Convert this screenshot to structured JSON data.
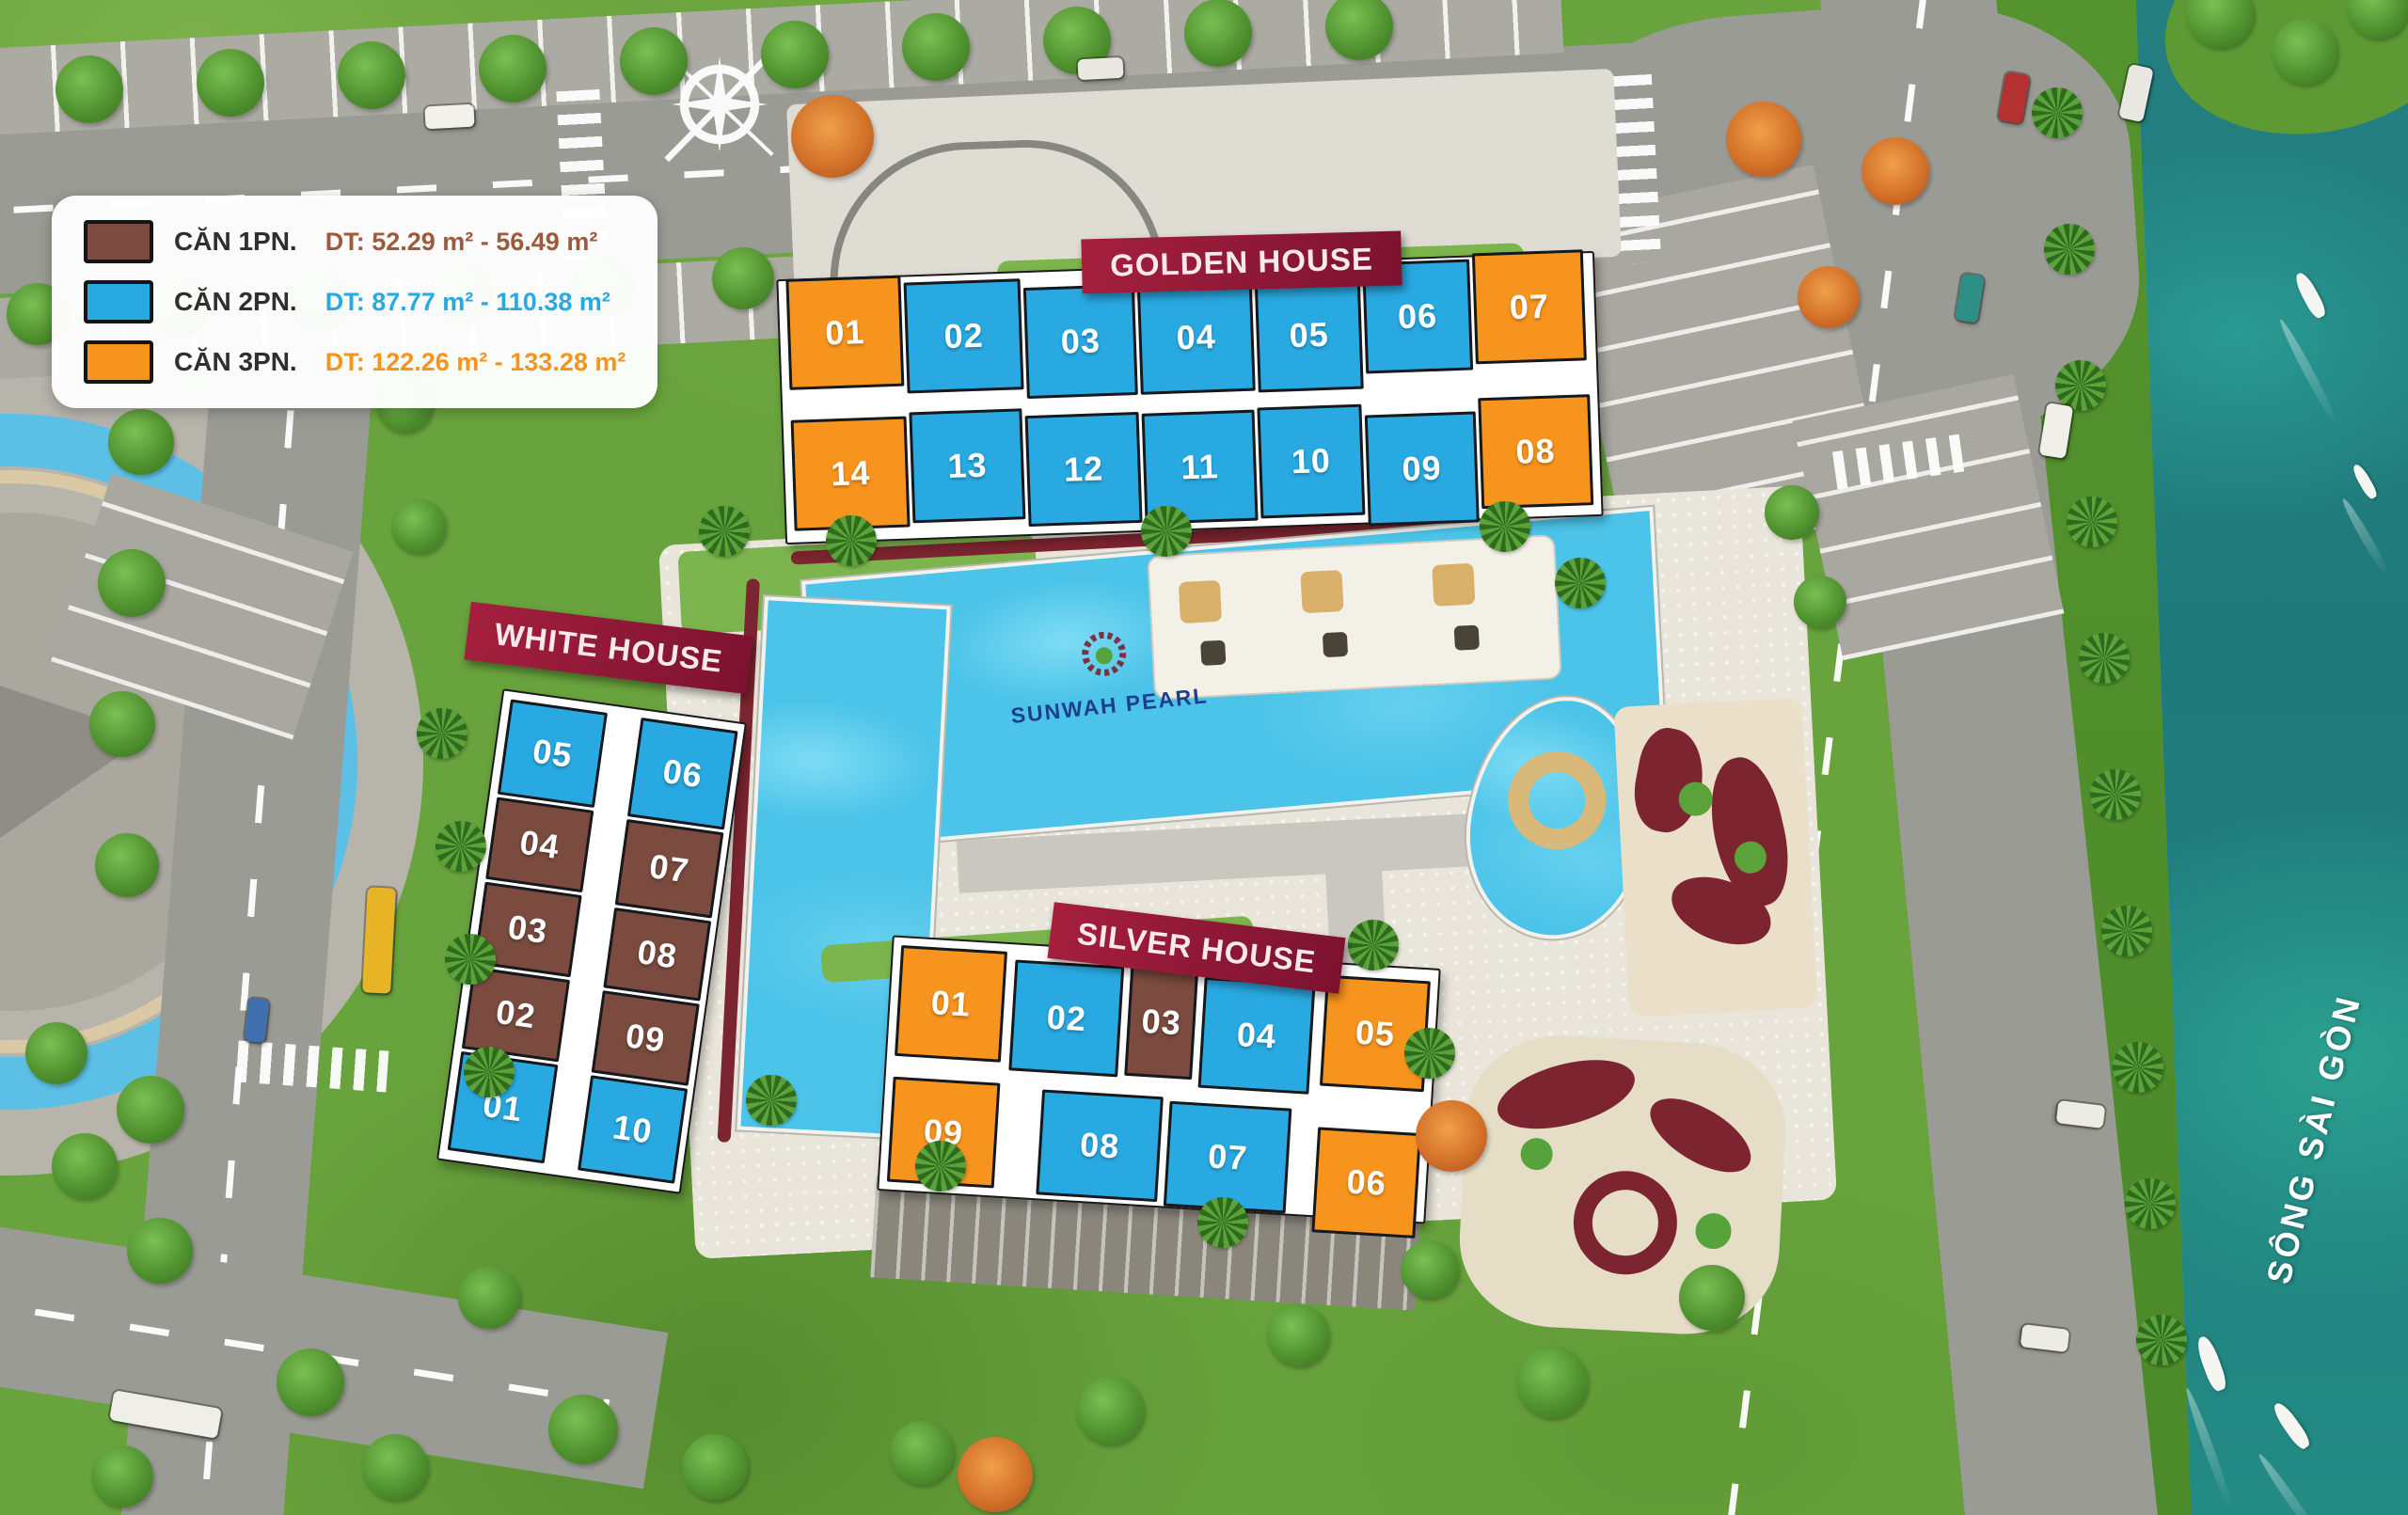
{
  "legend": {
    "items": [
      {
        "label": "CĂN 1PN.",
        "detail": "DT: 52.29 m² - 56.49 m²",
        "type": "1pn",
        "detail_color": "#9c5b3c"
      },
      {
        "label": "CĂN 2PN.",
        "detail": "DT: 87.77 m² - 110.38 m²",
        "type": "2pn",
        "detail_color": "#29a9e1"
      },
      {
        "label": "CĂN 3PN.",
        "detail": "DT: 122.26 m² - 133.28 m²",
        "type": "3pn",
        "detail_color": "#f7941e"
      }
    ]
  },
  "colors": {
    "1pn": "#7a4b3e",
    "2pn": "#29a9e1",
    "3pn": "#f7941e",
    "banner": "#8e1734",
    "river": "#20807f",
    "road": "#9b9b95",
    "grass": "#69a33d",
    "pool": "#4cc4e9"
  },
  "buildings": {
    "golden": {
      "name": "GOLDEN HOUSE",
      "rows": [
        {
          "units": [
            {
              "no": "01",
              "type": "3pn"
            },
            {
              "no": "02",
              "type": "2pn"
            },
            {
              "no": "03",
              "type": "2pn"
            },
            {
              "no": "04",
              "type": "2pn"
            },
            {
              "no": "05",
              "type": "2pn"
            },
            {
              "no": "06",
              "type": "2pn"
            },
            {
              "no": "07",
              "type": "3pn"
            }
          ]
        },
        {
          "units": [
            {
              "no": "14",
              "type": "3pn"
            },
            {
              "no": "13",
              "type": "2pn"
            },
            {
              "no": "12",
              "type": "2pn"
            },
            {
              "no": "11",
              "type": "2pn"
            },
            {
              "no": "10",
              "type": "2pn"
            },
            {
              "no": "09",
              "type": "2pn"
            },
            {
              "no": "08",
              "type": "3pn"
            }
          ]
        }
      ]
    },
    "white": {
      "name": "WHITE HOUSE",
      "columns": [
        {
          "units": [
            {
              "no": "05",
              "type": "2pn"
            },
            {
              "no": "04",
              "type": "1pn"
            },
            {
              "no": "03",
              "type": "1pn"
            },
            {
              "no": "02",
              "type": "1pn"
            },
            {
              "no": "01",
              "type": "2pn"
            }
          ]
        },
        {
          "units": [
            {
              "no": "06",
              "type": "2pn"
            },
            {
              "no": "07",
              "type": "1pn"
            },
            {
              "no": "08",
              "type": "1pn"
            },
            {
              "no": "09",
              "type": "1pn"
            },
            {
              "no": "10",
              "type": "2pn"
            }
          ]
        }
      ]
    },
    "silver": {
      "name": "SILVER HOUSE",
      "rows": [
        {
          "units": [
            {
              "no": "01",
              "type": "3pn"
            },
            {
              "no": "02",
              "type": "2pn"
            },
            {
              "no": "03",
              "type": "1pn"
            },
            {
              "no": "04",
              "type": "2pn"
            },
            {
              "no": "05",
              "type": "3pn"
            }
          ]
        },
        {
          "units": [
            {
              "no": "09",
              "type": "3pn"
            },
            {
              "no": "08",
              "type": "2pn"
            },
            {
              "no": "07",
              "type": "2pn"
            },
            {
              "no": "06",
              "type": "3pn"
            }
          ]
        }
      ]
    }
  },
  "pool": {
    "logo_text": "SUNWAH PEARL"
  },
  "river": {
    "label": "SÔNG SÀI GÒN"
  },
  "compass": {
    "north_label": "N"
  }
}
